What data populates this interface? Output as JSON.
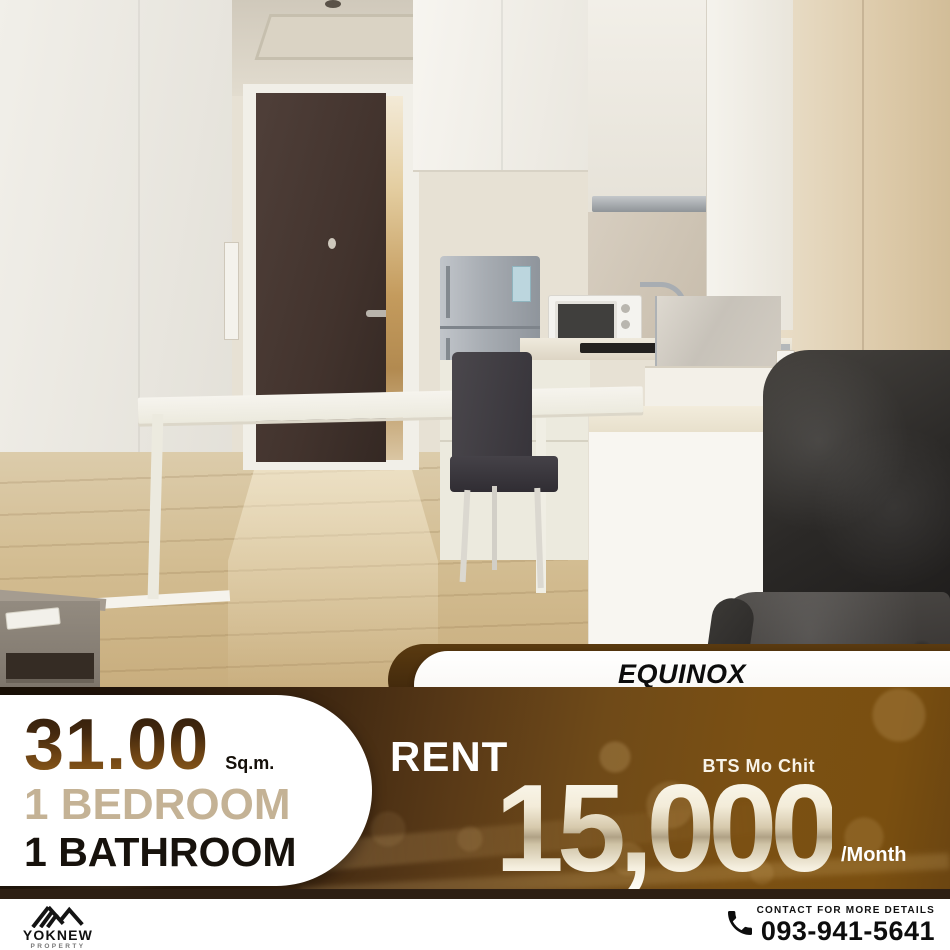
{
  "flyer": {
    "photo_alt": "Furnished condo interior: entrance door, white kitchen with fridge and microwave, dining table with chair, black leather sofa, wood floor",
    "property_banner": {
      "name": "EQUINOX",
      "location": "Phahol - Vibha"
    },
    "specs": {
      "area_value": "31.00",
      "area_unit": "Sq.m.",
      "bedroom": "1 BEDROOM",
      "bathroom": "1 BATHROOM"
    },
    "offer": {
      "label": "RENT",
      "station": "BTS Mo Chit",
      "price": "15,000",
      "per": "/Month"
    },
    "footer": {
      "brand": "YOKNEW",
      "brand_sub": "PROPERTY",
      "contact_label": "CONTACT FOR MORE DETAILS",
      "phone": "093-941-5641"
    },
    "icons": {
      "phone": "phone-handset",
      "brand_logo": "roof-chevron-lines"
    },
    "colors": {
      "band_dark_brown": "#20130a",
      "band_gold_brown": "#7b5013",
      "area_number_gradient_top": "#2f1d0c",
      "area_number_gradient_bottom": "#925f1c",
      "bedroom_tan": "#c4b295",
      "price_metallic_light": "#fcfaf1",
      "price_metallic_shadow": "#b0a185",
      "stripe_brown": "#2e1f13",
      "banner_white": "#ffffff"
    }
  }
}
